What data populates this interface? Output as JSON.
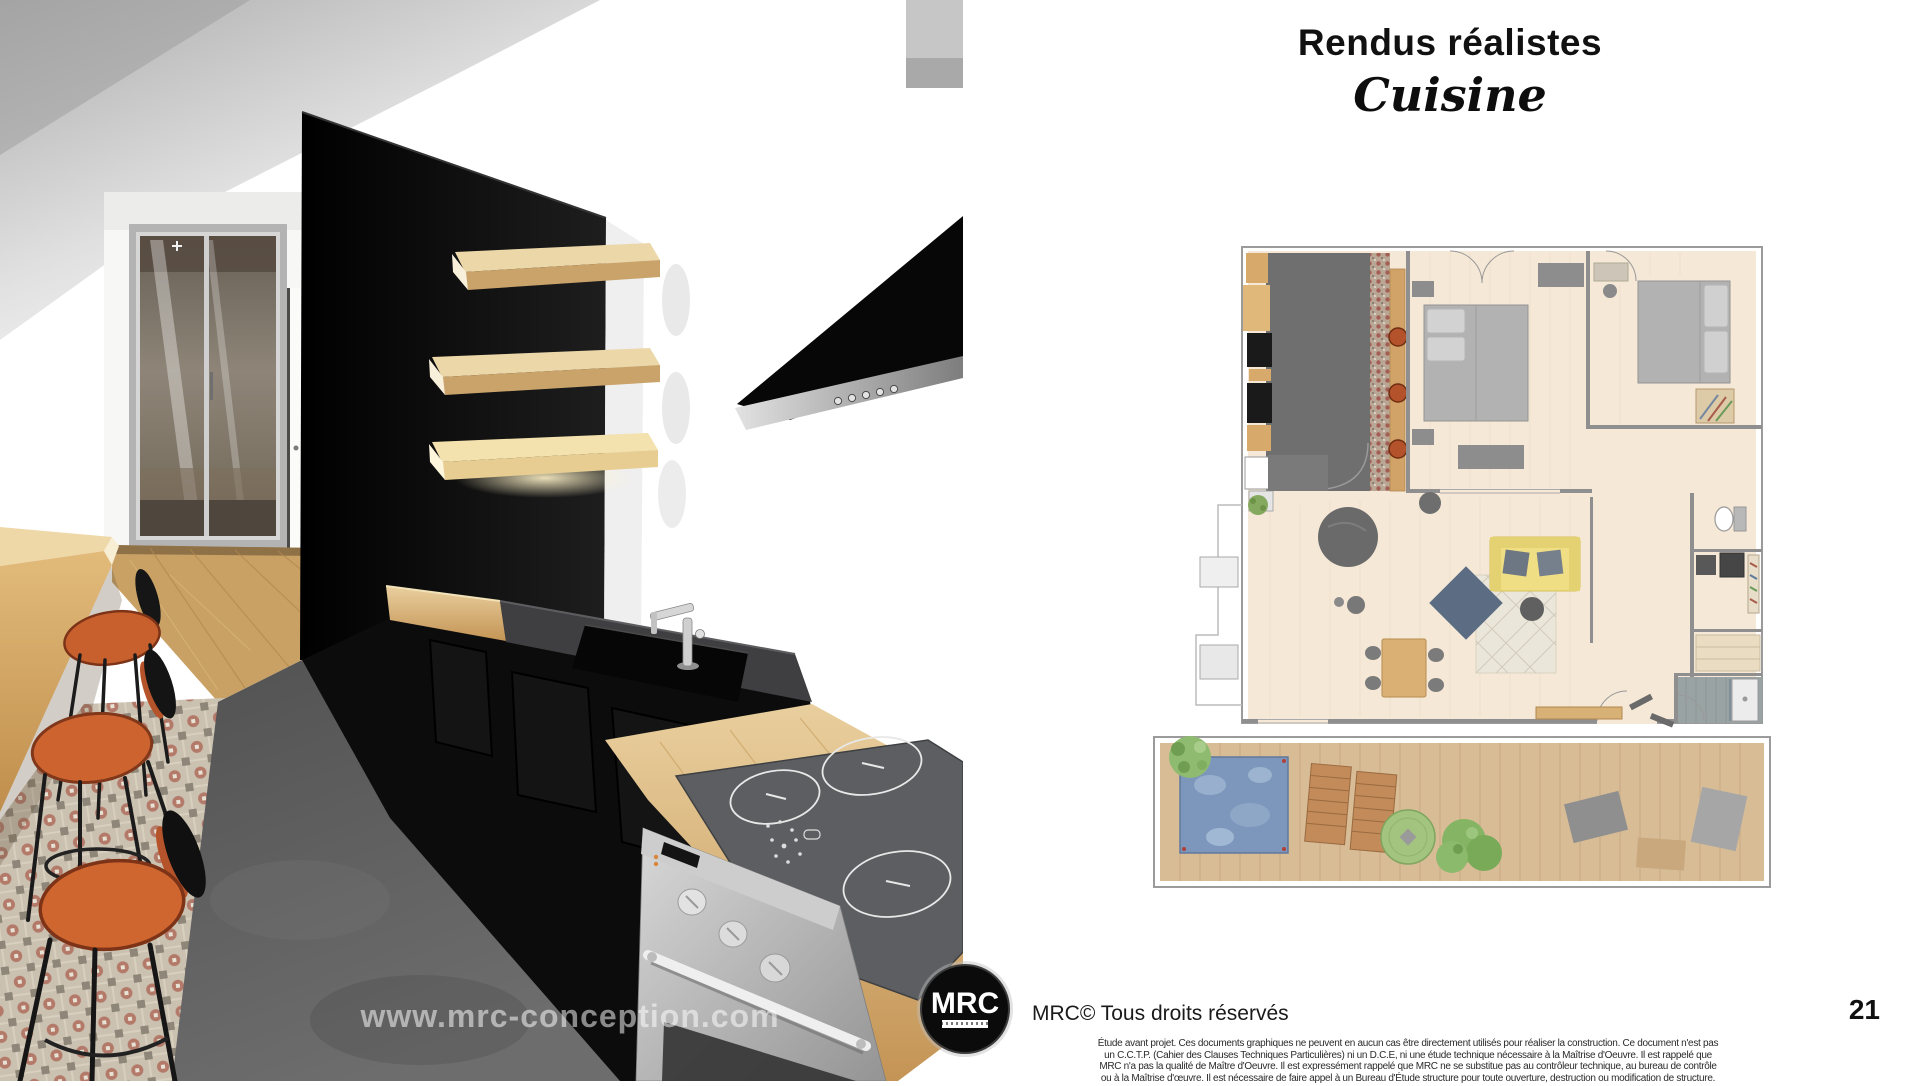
{
  "page": {
    "title": "Rendus réalistes",
    "subtitle": "Cuisine",
    "watermark": "www.mrc-conception.com",
    "logo_text": "MRC",
    "copyright": "MRC© Tous droits réservés",
    "page_number": "21",
    "disclaimer_lines": [
      "Étude avant projet. Ces documents graphiques ne peuvent en aucun cas être directement utilisés pour réaliser la construction. Ce document n'est pas",
      "un C.C.T.P. (Cahier des Clauses Techniques Particulières) ni un D.C.E, ni une étude technique nécessaire à la Maîtrise d'Oeuvre. Il est rappelé que",
      "MRC n'a pas la qualité de Maître d'Oeuvre. Il est expressément rappelé que MRC ne se substitue pas au contrôleur technique, au bureau de contrôle",
      "ou à la Maîtrise d'œuvre. Il est nécessaire de faire appel à un Bureau d'Étude structure pour toute ouverture, destruction ou modification de structure."
    ]
  },
  "colors": {
    "wood": "#d2a368",
    "cabinet_black": "#0c0c0c",
    "stool_orange": "#c8602e",
    "plan_floor_beige": "#f5e8d6",
    "plan_kitchen_floor": "#6f6f6f",
    "terrace_tan": "#d8bc96",
    "pool_blue": "#7d97bc",
    "sofa_yellow": "#efde83",
    "page_background": "#ffffff"
  }
}
